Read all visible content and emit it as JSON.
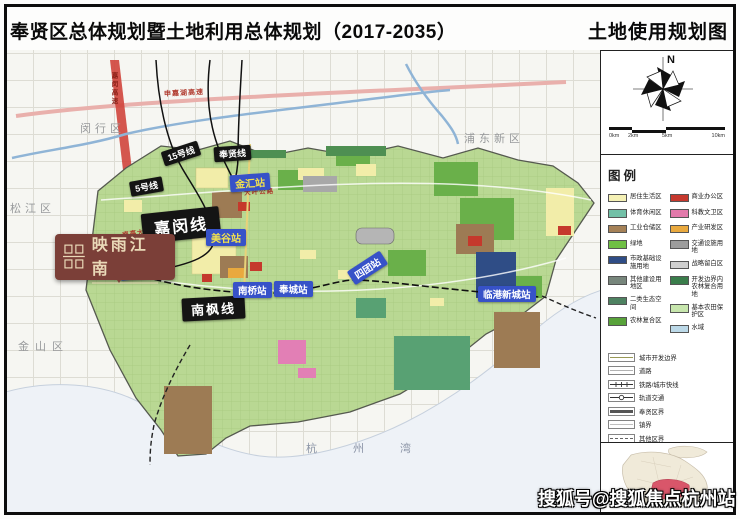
{
  "header": {
    "title": "奉贤区总体规划暨土地利用总体规划（2017-2035）",
    "map_title": "土地使用规划图"
  },
  "regions": {
    "minhang": "闵行区",
    "songjiang": "松江区",
    "pudong": "浦东新区",
    "jinshan": "金山区",
    "hangzhou_bay": "杭州湾"
  },
  "rail_labels": [
    {
      "label": "15号线"
    },
    {
      "label": "5号线"
    },
    {
      "label": "奉贤线"
    },
    {
      "label": "嘉闵线"
    },
    {
      "label": "南枫线"
    }
  ],
  "stations": [
    {
      "label": "金汇站"
    },
    {
      "label": "美谷站"
    },
    {
      "label": "庄行站"
    },
    {
      "label": "南桥站"
    },
    {
      "label": "奉城站"
    },
    {
      "label": "四团站"
    },
    {
      "label": "临港新城站"
    }
  ],
  "roads": {
    "shenjiahu": "申嘉湖高速",
    "jiamin": "嘉闵高速",
    "daye": "大叶公路",
    "nanting": "南亭大道",
    "huancheng": "环城东路",
    "jinqi": "金齐路"
  },
  "logo": {
    "name": "映雨江南"
  },
  "watermark": "搜狐号@搜狐焦点杭州站",
  "sidebar": {
    "north": "N",
    "scale_ticks": [
      "0km",
      "2km",
      "5km",
      "10km"
    ],
    "legend_title": "图例",
    "area_items_left": [
      {
        "label": "居住生活区",
        "color": "#f5f1b5"
      },
      {
        "label": "体育休闲区",
        "color": "#72c0a7"
      },
      {
        "label": "工业仓储区",
        "color": "#a58157"
      },
      {
        "label": "绿地",
        "color": "#6fbf44"
      },
      {
        "label": "市政基础设施用地",
        "color": "#2f4d86"
      },
      {
        "label": "其他建设用地区",
        "color": "#77867c"
      },
      {
        "label": "二类生态空间",
        "color": "#4e8261"
      },
      {
        "label": "农林复合区",
        "color": "#58a23a"
      }
    ],
    "area_items_right": [
      {
        "label": "商业办公区",
        "color": "#c6392e"
      },
      {
        "label": "科教文卫区",
        "color": "#e27aab"
      },
      {
        "label": "产业研发区",
        "color": "#e9a93e"
      },
      {
        "label": "交通设施用地",
        "color": "#9c9c9c"
      },
      {
        "label": "战略留白区",
        "color": "#cfcfcf"
      },
      {
        "label": "开发边界内农林复合用地",
        "color": "#3a7d4b"
      },
      {
        "label": "基本农田保护区",
        "color": "#c7e6ad"
      },
      {
        "label": "水域",
        "color": "#bcd9e8"
      }
    ],
    "line_items": [
      {
        "label": "城市开发边界"
      },
      {
        "label": "道路"
      },
      {
        "label": "铁路/城市快线"
      },
      {
        "label": "轨道交通"
      },
      {
        "label": "奉贤区界"
      },
      {
        "label": "镇界"
      },
      {
        "label": "其他区界"
      }
    ]
  }
}
